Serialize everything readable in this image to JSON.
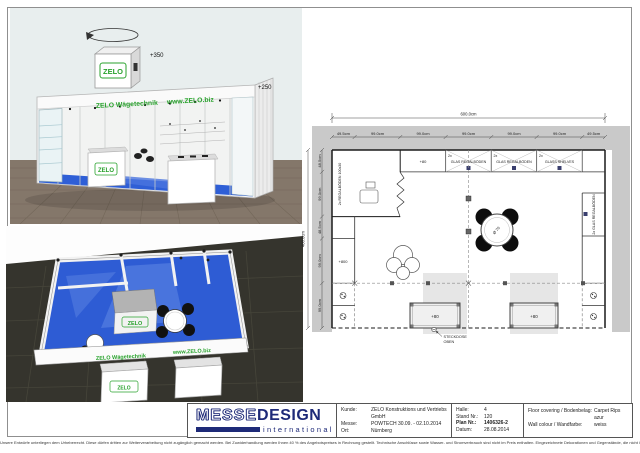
{
  "colors": {
    "carpet_blue": "#2f5fd6",
    "zelo_green": "#28a22c",
    "logo_navy": "#1e2a78"
  },
  "render_perspective": {
    "hanging_sign_height": "+350",
    "wall_height": "+250",
    "cube_logo": "ZELO",
    "banner_name": "ZELO Wägetechnik",
    "banner_url": "www.ZELO.biz",
    "counter_logo": "ZELO"
  },
  "render_topdown": {
    "box_logo": "ZELO",
    "counter_logo": "ZELO",
    "banner_name": "ZELO Wägetechnik",
    "banner_url": "www.ZELO.biz"
  },
  "floorplan": {
    "overall_width": "600.0cm",
    "overall_depth": "400.0cm",
    "top_segments": [
      "49.5cm",
      "99.0cm",
      "99.0cm",
      "99.0cm",
      "99.0cm",
      "99.0cm",
      "49.5cm"
    ],
    "left_segments": [
      "48.5cm",
      "99.0cm",
      "48.5cm",
      "99.0cm",
      "99.0cm"
    ],
    "storage_shelves": "2x REGALBÖDEN 100x30",
    "back_counter_height": "+80",
    "glass_cells": [
      {
        "qty": "2x",
        "label": "GLAS REGALBÖDEN"
      },
      {
        "qty": "2x",
        "label": "GLAS REGALBÖDEN"
      },
      {
        "qty": "2x",
        "label": "GLASS SHELVES"
      }
    ],
    "right_shelves": "2x GLAS REGALBÖDEN",
    "wall_height": "+800",
    "table_diameter": "Ø 70",
    "counter_left_height": "+80",
    "counter_right_height": "+80",
    "socket_line1": "STECKDOSE",
    "socket_line2": "OBEN"
  },
  "titleblock": {
    "logo": {
      "part1": "MESSE",
      "part2": "DESIGN",
      "subtitle": "international"
    },
    "client": {
      "label": "Kunde:",
      "value": "ZELO Konstruktions und Vertriebs GmbH"
    },
    "fair": {
      "label": "Messe:",
      "value": "POWTECH  30.09. - 02.10.2014"
    },
    "city": {
      "label": "Ort:",
      "value": "Nürnberg"
    },
    "hall": {
      "label": "Halle:",
      "value": "4"
    },
    "stand": {
      "label": "Stand Nr.:",
      "value": "120"
    },
    "plan": {
      "label": "Plan Nr.:",
      "value": "1406326-2"
    },
    "date": {
      "label": "Datum:",
      "value": "28.08.2014"
    },
    "floor": {
      "label": "Floor covering / Bodenbelag:",
      "value": "Carpet Rips"
    },
    "floor2": {
      "label": "",
      "value": "azur"
    },
    "wall": {
      "label": "Wall colour / Wandfarbe:",
      "value": "weiss"
    }
  },
  "sheet": {
    "disclaimer": "Unsere Entwürfe unterliegen dem Urheberrecht. Diese dürfen dritten zur Weiterverarbeitung nicht zugänglich gemacht werden. Bei Zuwiderhandlung werden Ihnen 40 % des Angebotspreises in Rechnung gestellt. Technische Anschlüsse sowie Wasser- und Stromverbrauch sind nicht im Preis enthalten. Eingezeichnete Dekorationen und Gegenstände, die nicht in der Leistungsbeschreibung enthalten sind, gehören nicht zum Lieferumfang. Änderungen durch die Messe bleiben vorbehalten."
  }
}
